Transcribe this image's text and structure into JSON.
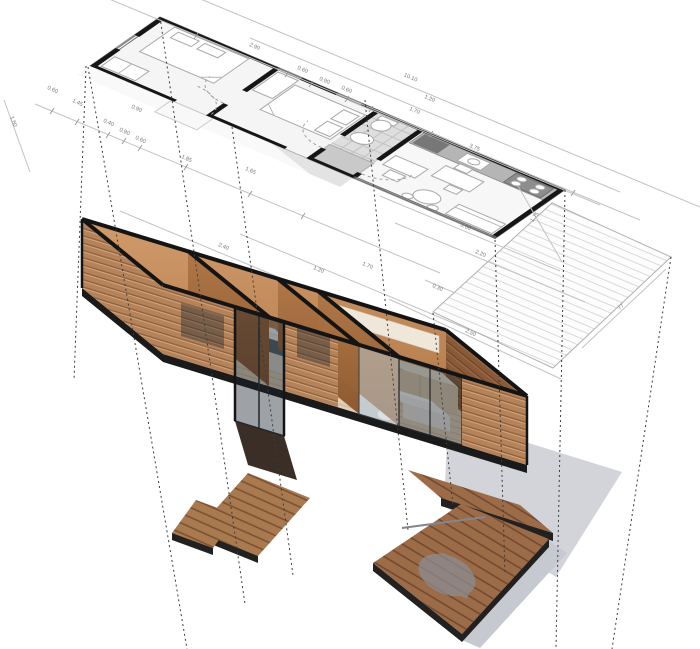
{
  "diagram": {
    "subject": "modular-house-axonometric-projection",
    "units": "m"
  },
  "plan_summary": {
    "overall_length": "10.10",
    "side_depth_segments": [
      "1.20",
      "1.70"
    ],
    "kitchen_front": "3.75",
    "deck_side": "2.50"
  },
  "dims": [
    {
      "t": "2.90"
    },
    {
      "t": "0.60"
    },
    {
      "t": "0.90"
    },
    {
      "t": "0.60"
    },
    {
      "t": "10.10"
    },
    {
      "t": "1.20"
    },
    {
      "t": "1.70"
    },
    {
      "t": "3.75"
    },
    {
      "t": "0.60"
    },
    {
      "t": "1.45"
    },
    {
      "t": "0.40"
    },
    {
      "t": "0.90"
    },
    {
      "t": "0.60"
    },
    {
      "t": "1.85"
    },
    {
      "t": "1.65"
    },
    {
      "t": "0.90"
    },
    {
      "t": "1.60"
    },
    {
      "t": "3.60"
    },
    {
      "t": "2.20"
    },
    {
      "t": "0.30"
    },
    {
      "t": "2.50"
    },
    {
      "t": "77"
    },
    {
      "t": "1.75"
    },
    {
      "t": "2.40"
    },
    {
      "t": "1.20"
    },
    {
      "t": "1.70"
    }
  ],
  "palette": {
    "wall_cut": "#141414",
    "osb_light": "#cf9a6b",
    "osb_dark": "#a9743f",
    "slat_wood": "#b5825a",
    "deck_wood": "#9c6b48",
    "floor_wood": "#decfb6",
    "bath_tile": "#cdd1d3",
    "glass": "rgba(30,38,46,0.40)",
    "shadow": "#caccd3",
    "dim_text": "#767676"
  }
}
